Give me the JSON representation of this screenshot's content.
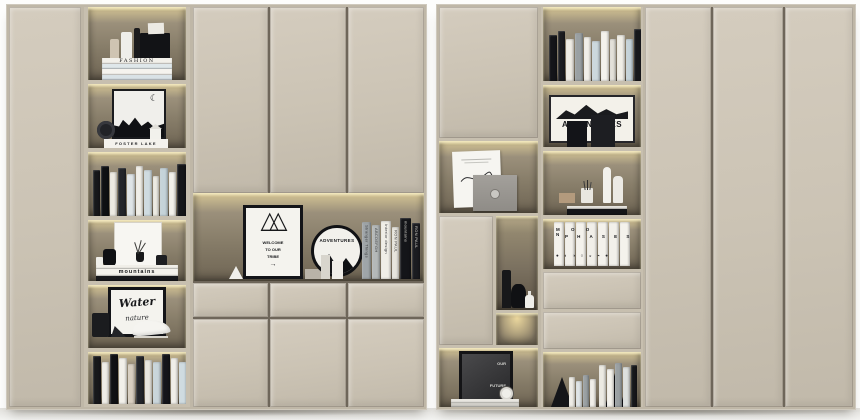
{
  "scene": {
    "description": "Two beige built-in cabinet wall units with warm LED-lit open shelves holding monochrome books and decor objects",
    "palette": {
      "cabinet_panel": "#cbc3b4",
      "cabinet_frame": "#bfb7a7",
      "panel_gap": "#6e665a",
      "shelf_back": "#8b8170",
      "led_glow": "#f2e0a9",
      "book_black": "#17181b",
      "book_white": "#efece4",
      "book_blue": "#ccd8dd",
      "book_grey": "#9aa0a3",
      "floor": "#e2e1dd",
      "background": "#fdfdfc"
    }
  },
  "left_unit": {
    "shelf1": {
      "book_stack_top_label": "FASHION"
    },
    "shelf2": {
      "letterboard_text": "FOSTER LAKE",
      "crescent_icon": "☾"
    },
    "shelf4": {
      "book_stack_label": "mountains"
    },
    "shelf5": {
      "poster_title": "Water",
      "poster_subtitle": "nature"
    },
    "display_niche": {
      "teepee_poster": {
        "tents_icon": "△△",
        "line1": "WELCOME",
        "line2": "TO OUR",
        "line3": "TRIBE",
        "arrow_icon": "→"
      },
      "round_sign_text": "ADVENTURES",
      "books": [
        {
          "label": "Stranger Things",
          "c": "#9fa5a8",
          "w": 9,
          "h": 57
        },
        {
          "label": "ABCDEFGH",
          "c": "#b4b8b8",
          "w": 8,
          "h": 54
        },
        {
          "label": "Interior design",
          "c": "#f0eee7",
          "w": 10,
          "h": 58
        },
        {
          "label": "RON PAUL",
          "c": "#e7e5dd",
          "w": 7,
          "h": 52
        },
        {
          "label": "mountains",
          "c": "#141519",
          "w": 11,
          "h": 61
        },
        {
          "label": "RON PAUL",
          "c": "#1b1c20",
          "w": 8,
          "h": 56
        }
      ]
    },
    "row3_books": [
      [
        "#17181b",
        7,
        46
      ],
      [
        "#0f1013",
        8,
        50
      ],
      [
        "#edeae2",
        7,
        44
      ],
      [
        "#23252a",
        8,
        48
      ],
      [
        "#dfe4e6",
        8,
        42
      ],
      [
        "#f1efe8",
        7,
        50
      ],
      [
        "#cfdbe0",
        8,
        46
      ],
      [
        "#eceae2",
        6,
        40
      ],
      [
        "#c5d3d9",
        8,
        48
      ],
      [
        "#f2f0ea",
        7,
        44
      ],
      [
        "#15161a",
        9,
        52
      ],
      [
        "#dde0de",
        7,
        46
      ]
    ],
    "row6_books": [
      [
        "#17181b",
        8,
        48
      ],
      [
        "#efede6",
        7,
        42
      ],
      [
        "#101114",
        8,
        50
      ],
      [
        "#f2f0ea",
        8,
        46
      ],
      [
        "#d9cfc0",
        7,
        40
      ],
      [
        "#23252a",
        8,
        48
      ],
      [
        "#e8e6df",
        7,
        44
      ],
      [
        "#c9d5da",
        8,
        42
      ],
      [
        "#14151a",
        8,
        50
      ],
      [
        "#f0eee8",
        7,
        46
      ],
      [
        "#cfdbe0",
        8,
        42
      ],
      [
        "#e6e4dc",
        6,
        48
      ]
    ]
  },
  "right_unit": {
    "colA": {
      "future_poster": {
        "line1": "OUR",
        "line2": "FUTURE"
      }
    },
    "colB": {
      "poster_adventure": "ADVENTURES",
      "moon_phases": {
        "line1": "M O O N",
        "line2": "P H A S E S",
        "phases": "●◐◑○◒◓●"
      },
      "row1_books": [
        [
          "#141519",
          8,
          46
        ],
        [
          "#1b1c20",
          7,
          50
        ],
        [
          "#efece4",
          8,
          42
        ],
        [
          "#9aa0a3",
          8,
          48
        ],
        [
          "#f1efe9",
          7,
          44
        ],
        [
          "#ccd8dd",
          8,
          40
        ],
        [
          "#f4f2ec",
          8,
          50
        ],
        [
          "#e3e1d9",
          6,
          42
        ],
        [
          "#f0eee6",
          8,
          46
        ],
        [
          "#c5d3d9",
          7,
          42
        ],
        [
          "#17181b",
          9,
          52
        ]
      ],
      "bottom_left_books": [
        [
          "#efede6",
          6,
          30
        ],
        [
          "#dfe4e6",
          6,
          26
        ],
        [
          "#9aa0a3",
          6,
          32
        ],
        [
          "#f1efe9",
          6,
          28
        ]
      ],
      "bottom_right_books": [
        [
          "#eceae2",
          7,
          42
        ],
        [
          "#f4f2ec",
          7,
          38
        ],
        [
          "#9aa0a3",
          7,
          44
        ],
        [
          "#dde0de",
          7,
          40
        ],
        [
          "#17181b",
          6,
          42
        ]
      ]
    }
  }
}
